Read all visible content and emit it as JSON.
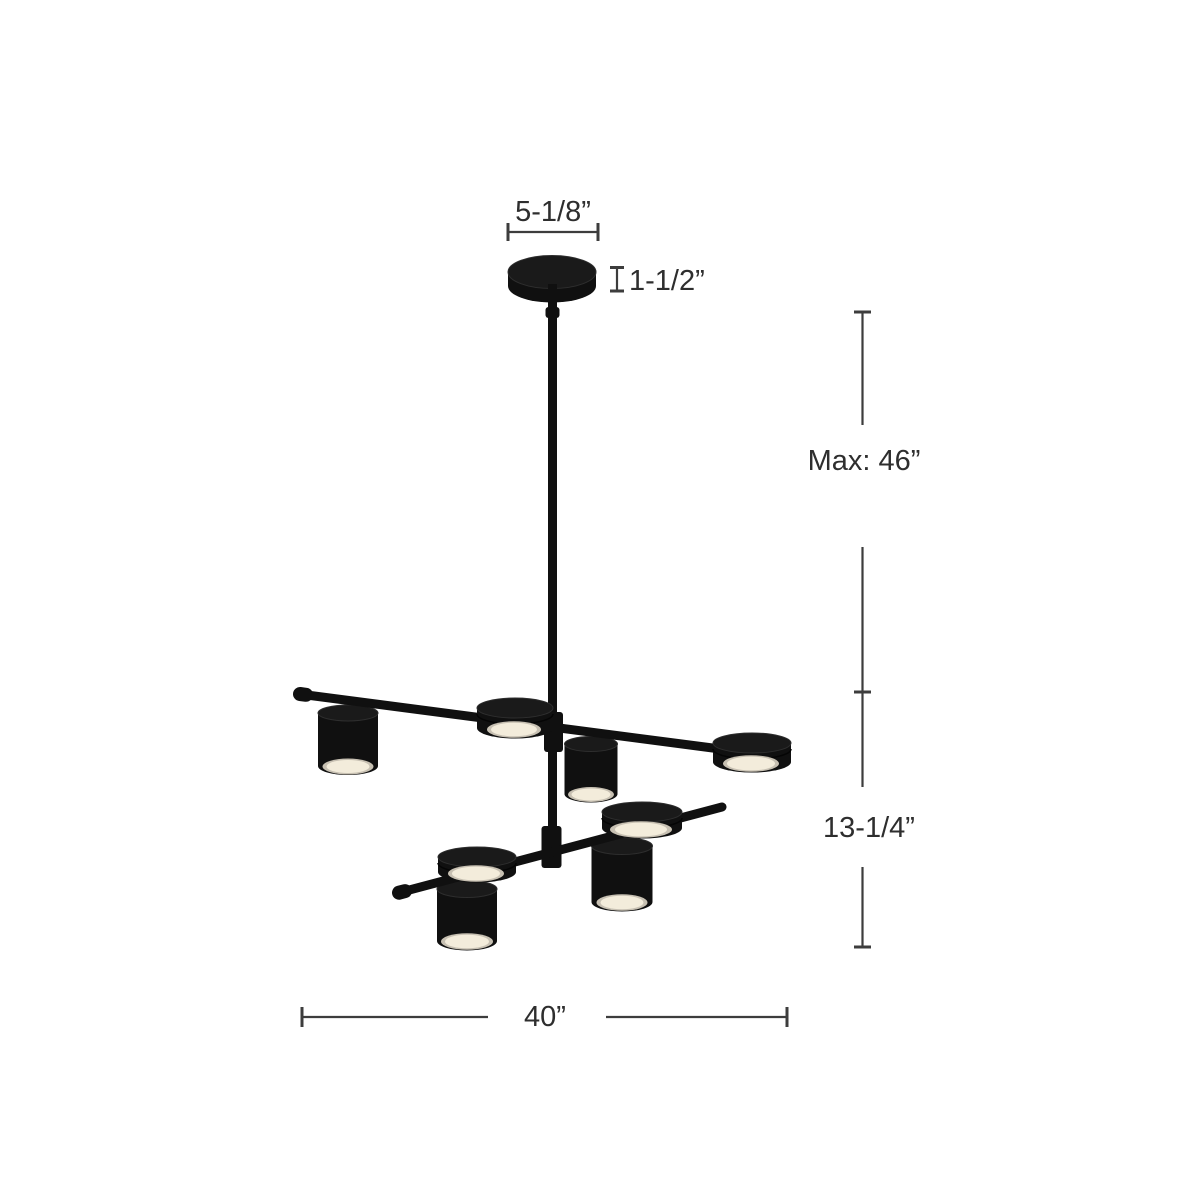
{
  "page": {
    "background": "#ffffff",
    "description": "Product dimension line-drawing of a two-tier eight-light LED chandelier"
  },
  "fixture": {
    "type": "two-tier linear chandelier",
    "finish_color": "#101010",
    "lens_color": "#f3ecdb",
    "lens_ring_color": "#c7c0b2",
    "lights_on_upper_arm": 4,
    "lights_on_lower_arm": 4
  },
  "annotation_style": {
    "line_color": "#3d3d3d",
    "text_color": "#2e2e2e"
  },
  "dimensions": {
    "canopy_width": {
      "label": "5-1/8”"
    },
    "canopy_height": {
      "label": "1-1/2”"
    },
    "max_height": {
      "label": "Max: 46”"
    },
    "fixture_height": {
      "label": "13-1/4”"
    },
    "fixture_width": {
      "label": "40”"
    }
  }
}
